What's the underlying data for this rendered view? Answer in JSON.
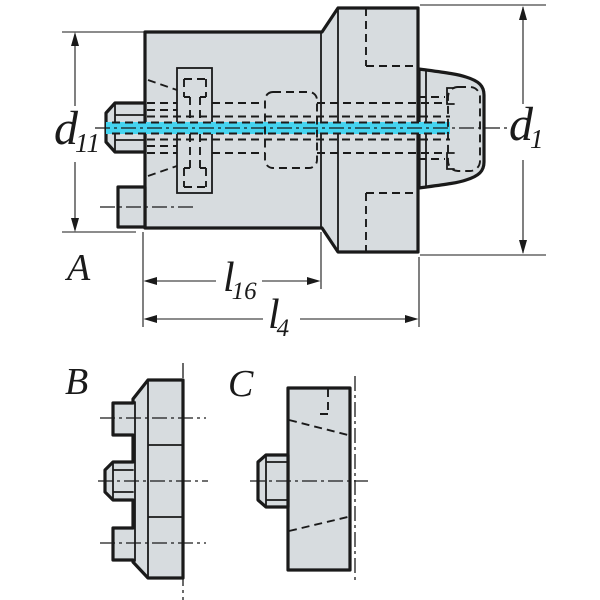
{
  "drawing_kind": "tool-adapter-engineering-drawing",
  "views": {
    "main": {
      "label": "A"
    },
    "front": {
      "label": "B"
    },
    "side": {
      "label": "C"
    }
  },
  "dimensions": {
    "d11": {
      "base": "d",
      "sub": "11"
    },
    "d1": {
      "base": "d",
      "sub": "1"
    },
    "l16": {
      "base": "l",
      "sub": "16"
    },
    "l4": {
      "base": "l",
      "sub": "4"
    }
  },
  "colors": {
    "background": "#ffffff",
    "line": "#1a1a1a",
    "body_fill": "#d7dcdf",
    "highlight_cyan": "#45d4f0"
  }
}
